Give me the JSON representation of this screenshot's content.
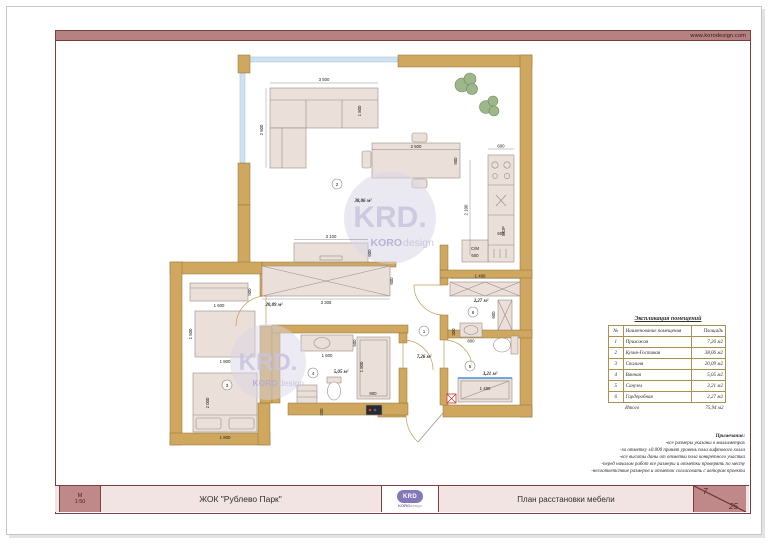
{
  "page": {
    "url": "www.korodesign.com"
  },
  "colors": {
    "wall": "#cfa75f",
    "wall_outline": "#8c7338",
    "rose": "#b58181",
    "rose_dark": "#7a4040",
    "panel_pink": "#f3e4e4",
    "purple": "#8578b8",
    "furniture": "#eadfd9",
    "window": "#cfe2ef",
    "tub_edge": "#4a90d9",
    "table_border": "#a8924f"
  },
  "title_block": {
    "scale_label": "М",
    "scale_value": "1:50",
    "project": "ЖОК \"Рублево Парк\"",
    "drawing": "План расстановки мебели",
    "sheet_number": "7",
    "sheet_total": "25",
    "logo": {
      "krd": "KRD",
      "koro": "KORO",
      "design": "design"
    }
  },
  "watermark": {
    "krd": "KRD.",
    "koro": "KORO",
    "design": "design"
  },
  "legend": {
    "title": "Экспликация помещений",
    "columns": [
      "№",
      "Наименование помещения",
      "Площадь"
    ],
    "rows": [
      {
        "num": "1",
        "name": "Прихожая",
        "area": "7,26 м2"
      },
      {
        "num": "2",
        "name": "Кухня-Гостиная",
        "area": "38,06 м2"
      },
      {
        "num": "3",
        "name": "Спальня",
        "area": "20,09 м2"
      },
      {
        "num": "4",
        "name": "Ванная",
        "area": "5,05 м2"
      },
      {
        "num": "5",
        "name": "Санузел",
        "area": "3,21 м2"
      },
      {
        "num": "6",
        "name": "Гардеробная",
        "area": "2,27 м2"
      }
    ],
    "total_label": "Итого",
    "total_value": "75,94 м2"
  },
  "notes": {
    "title": "Примечание:",
    "lines": [
      "-все размеры указаны в миллиметрах",
      "-за отметку ±0.000 принят уровень пола лифтового холла",
      "-все высоты даны от отметки пола конкретного участка",
      "-перед началом работ все размеры и отметки проверять по месту",
      "-несоответствие размеров и отметок согласовать с автором проекта"
    ]
  },
  "plan": {
    "rooms": [
      {
        "num": "1",
        "area": "7,26 м²"
      },
      {
        "num": "2",
        "area": "38,06 м²"
      },
      {
        "num": "3",
        "area": "20,09 м²"
      },
      {
        "num": "4",
        "area": "5,05 м²"
      },
      {
        "num": "5",
        "area": "3,21 м²"
      },
      {
        "num": "6",
        "area": "2,27 м²"
      }
    ],
    "labels": {
      "washing_machine": "С/М",
      "appliance": "МОР",
      "sink_cross": "×"
    },
    "dims": {
      "sofa_w": "3 500",
      "sofa_d": "2 600",
      "sofa_leg": "1 800",
      "table_w": "2 500",
      "table_d": "900",
      "kitchen_h": "2 100",
      "kitchen_top": "600",
      "kitchen_mid": "600",
      "cm_w": "600",
      "tv_w": "3 100",
      "tv_d": "600",
      "hall_wardrobe_w": "3 305",
      "hall_wardrobe_d": "600",
      "dresser_w": "1 600",
      "dresser_d": "500",
      "cab_h": "1 500",
      "cab_w": "1 800",
      "bed_l": "2 000",
      "bed_w": "1 800",
      "vanity_w": "1 600",
      "vanity_d": "500",
      "shower_l": "1 800",
      "shower_w": "900",
      "bath_off": "200",
      "wc_sink_w": "800",
      "wc_sink_d": "300",
      "tub_w": "1 480",
      "ward6_w": "1 480",
      "ward6_d": "600"
    }
  }
}
